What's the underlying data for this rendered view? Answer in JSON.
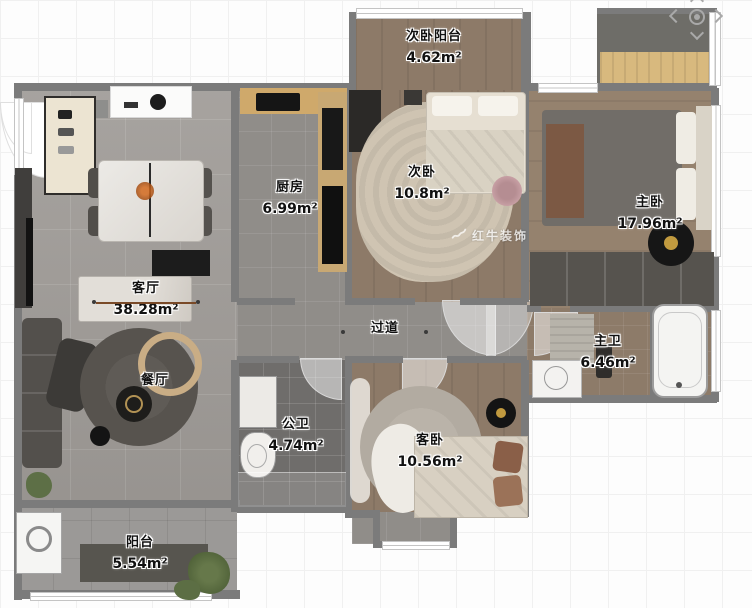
{
  "watermark": {
    "brand": "红牛装饰"
  },
  "pan_control": {
    "up": "pan-up",
    "down": "pan-down",
    "left": "pan-left",
    "right": "pan-right",
    "center": "recenter"
  },
  "rooms": [
    {
      "name": "次卧阳台",
      "area": "4.62m²"
    },
    {
      "name": "次卧",
      "area": "10.8m²"
    },
    {
      "name": "主卧",
      "area": "17.96m²"
    },
    {
      "name": "厨房",
      "area": "6.99m²"
    },
    {
      "name": "客厅",
      "area": "38.28m²"
    },
    {
      "name": "过道",
      "area": ""
    },
    {
      "name": "餐厅",
      "area": ""
    },
    {
      "name": "公卫",
      "area": "4.74m²"
    },
    {
      "name": "客卧",
      "area": "10.56m²"
    },
    {
      "name": "主卫",
      "area": "6.46m²"
    },
    {
      "name": "阳台",
      "area": "5.54m²"
    }
  ]
}
